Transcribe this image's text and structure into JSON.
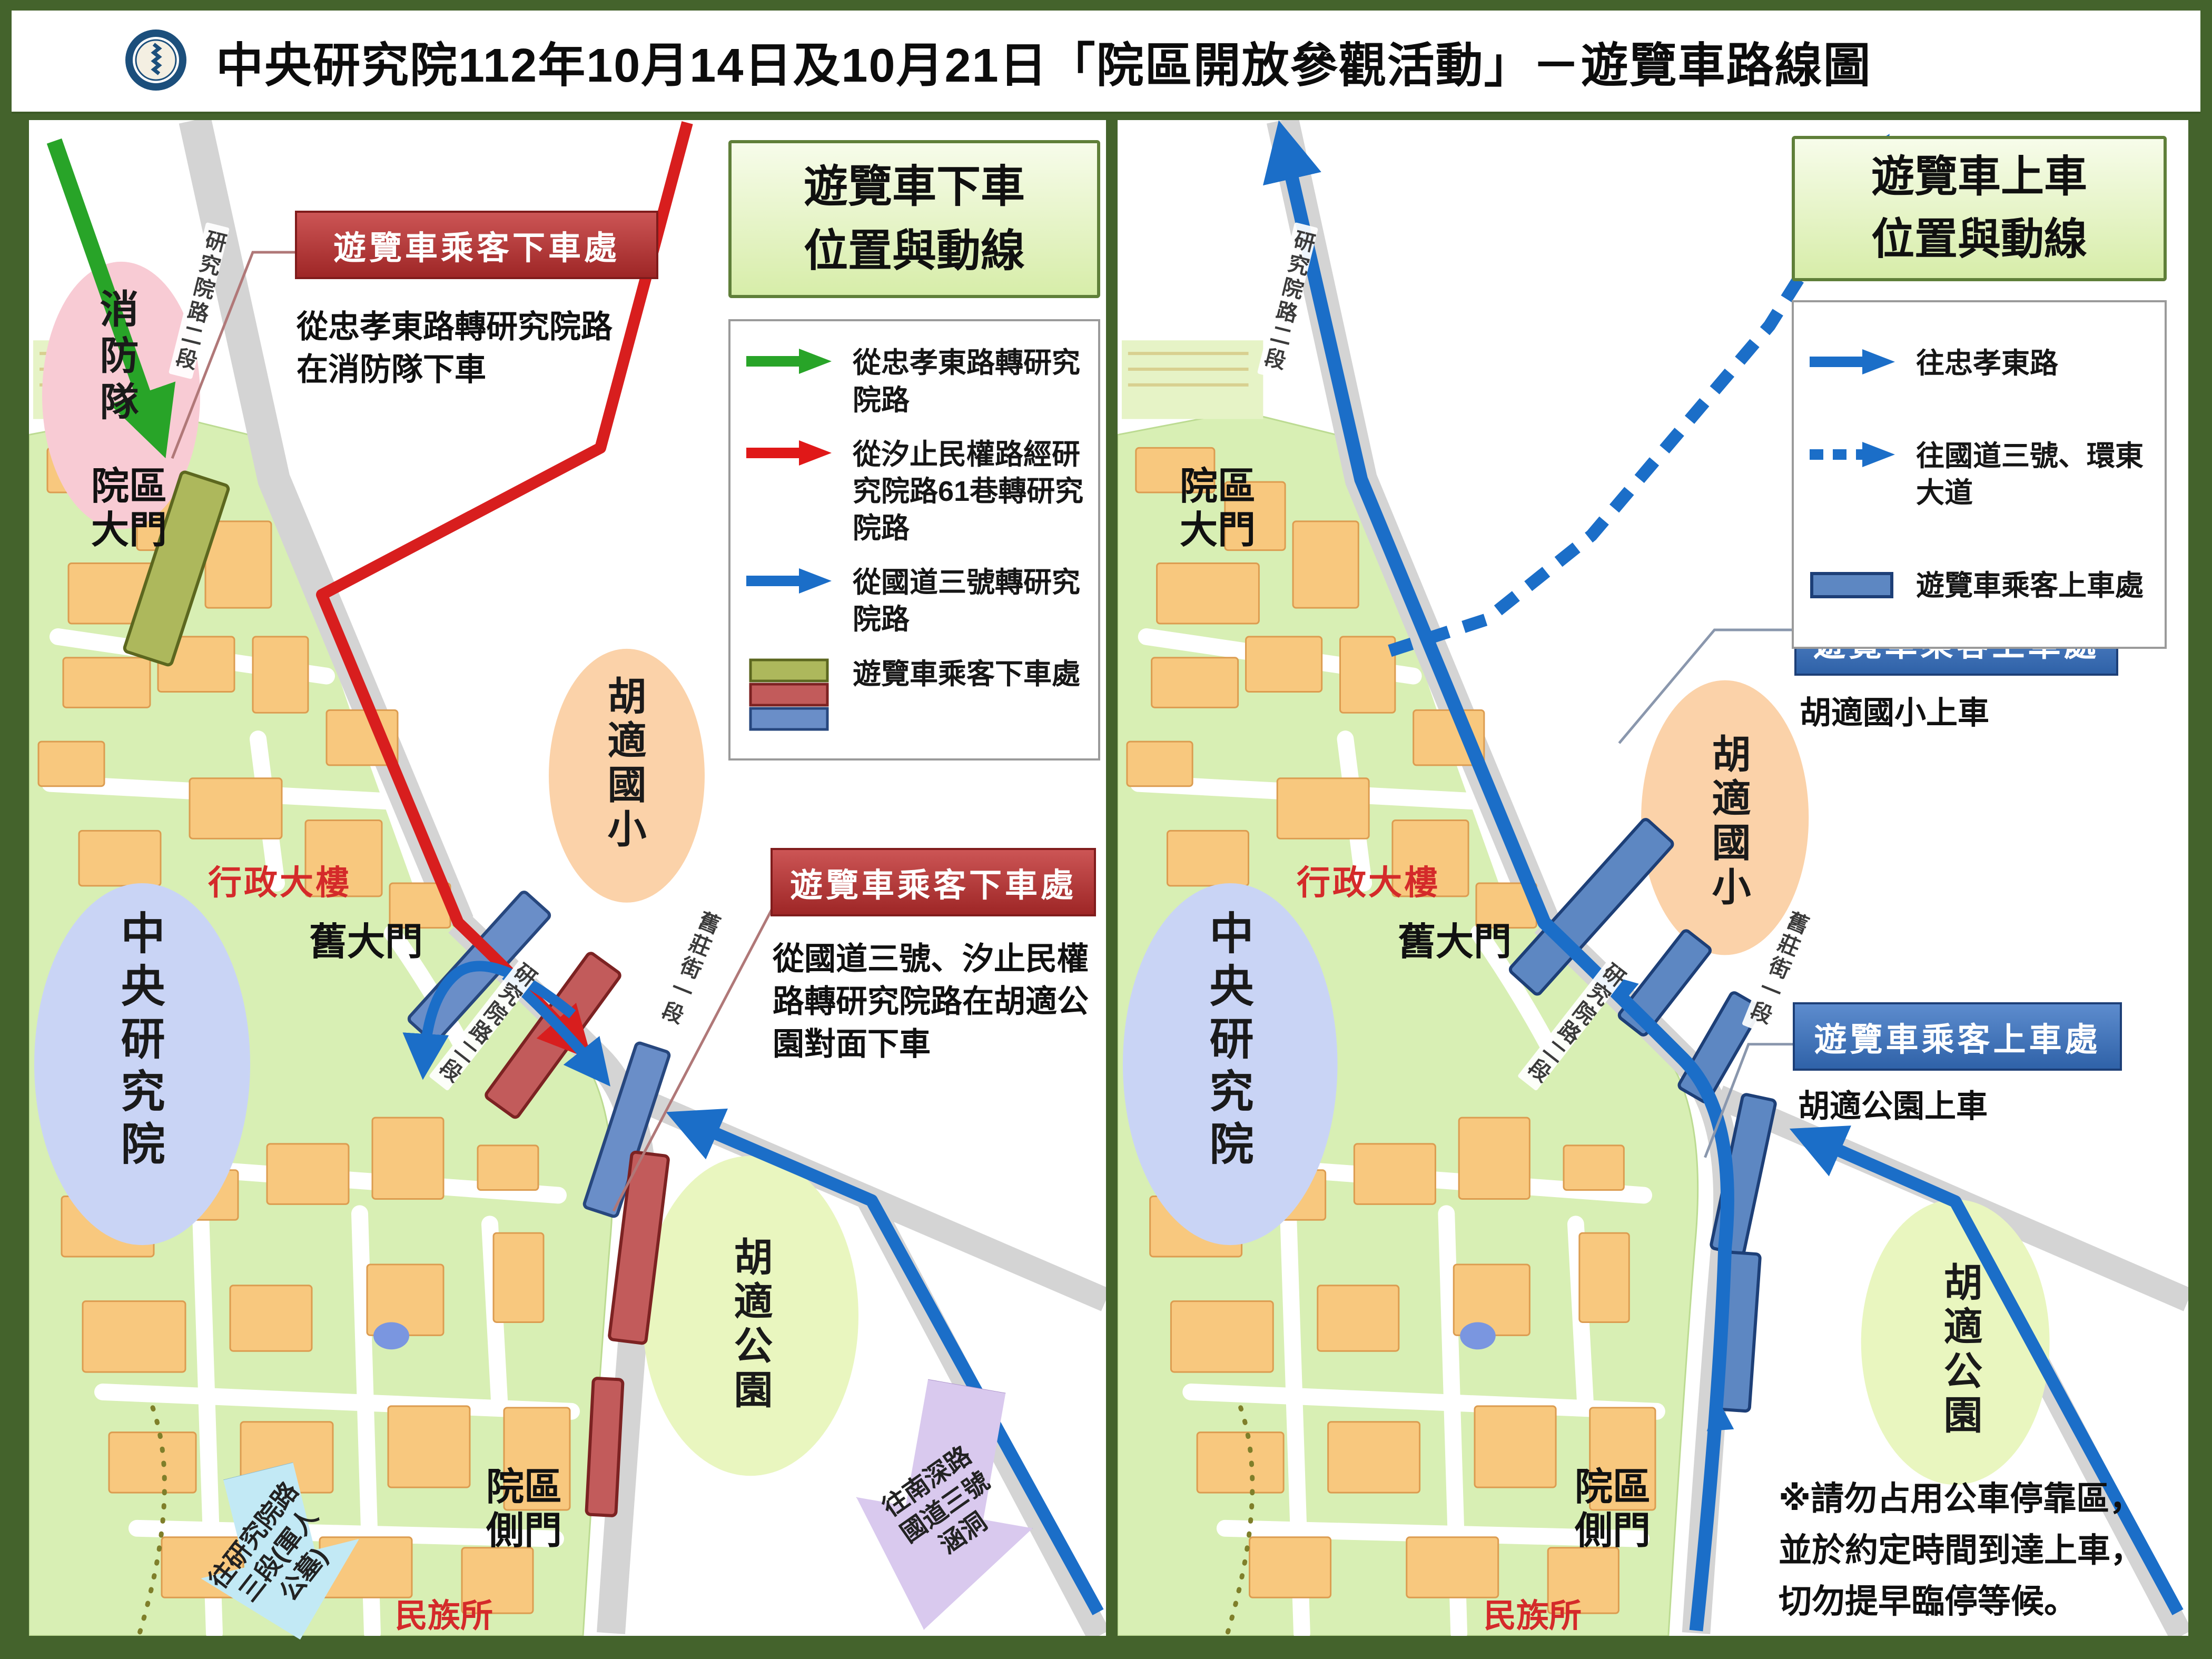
{
  "title": "中央研究院112年10月14日及10月21日「院區開放參觀活動」－遊覽車路線圖",
  "colors": {
    "route_green": "#28a428",
    "route_red": "#d81e1e",
    "route_blue": "#1b6ec8",
    "dropoff_badge_red": "#a02828",
    "pickup_badge_blue": "#2f62a8",
    "stop_olive": "#adb85c",
    "stop_red": "#c25b5b",
    "stop_blue": "#6a8ec8",
    "campus_green": "#d8efb4",
    "building_orange": "#f8c87e",
    "road_gray": "#d4d4d4",
    "frame_green": "#44632c"
  },
  "places": {
    "fire_station": "消防隊",
    "main_gate": "院區大門",
    "admin_building": "行政大樓",
    "old_gate": "舊大門",
    "academia_sinica": "中央研究院",
    "hu_shih_school": "胡適國小",
    "hu_shih_park": "胡適公園",
    "side_gate": "院區側門",
    "ethnology_institute": "民族所"
  },
  "roads": {
    "yanjiuyuan_rd_sec2": "研究院路二段",
    "jiuzhuang_st_sec1": "舊莊街一段"
  },
  "left_map": {
    "legend_title": "遊覽車下車\n位置與動線",
    "legend": [
      {
        "label": "從忠孝東路轉研究院路"
      },
      {
        "label": "從汐止民權路經研究院路61巷轉研究院路"
      },
      {
        "label": "從國道三號轉研究院路"
      },
      {
        "label": "遊覽車乘客下車處"
      }
    ],
    "dropoff1": {
      "title": "遊覽車乘客下車處",
      "desc": "從忠孝東路轉研究院路在消防隊下車"
    },
    "dropoff2": {
      "title": "遊覽車乘客下車處",
      "desc": "從國道三號、汐止民權路轉研究院路在胡適公園對面下車"
    },
    "exit_left": "往研究院路三段(軍人公墓)",
    "exit_right": "往南深路國道三號涵洞"
  },
  "right_map": {
    "legend_title": "遊覽車上車\n位置與動線",
    "legend": [
      {
        "label": "往忠孝東路"
      },
      {
        "label": "往國道三號、環東大道"
      },
      {
        "label": "遊覽車乘客上車處"
      }
    ],
    "pickup1": {
      "title": "遊覽車乘客上車處",
      "desc": "胡適國小上車"
    },
    "pickup2": {
      "title": "遊覽車乘客上車處",
      "desc": "胡適公園上車"
    },
    "note": "※請勿占用公車停靠區，\n並於約定時間到達上車，\n切勿提早臨停等候。"
  }
}
